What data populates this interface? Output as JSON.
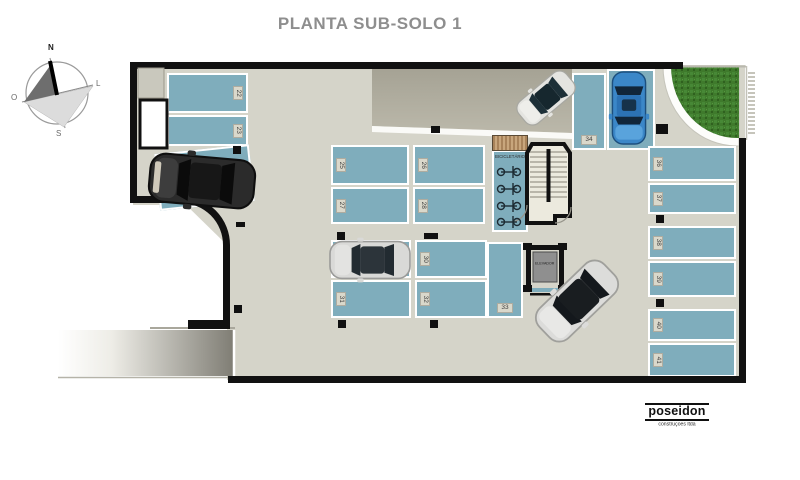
{
  "title": "PLANTA SUB-SOLO 1",
  "compass": {
    "north": "N",
    "south": "S",
    "east": "L",
    "west": "O"
  },
  "plan": {
    "spots": {
      "s22": "22",
      "s23": "23",
      "s25": "25",
      "s26": "26",
      "s27": "27",
      "s28": "28",
      "s30": "30",
      "s31": "31",
      "s32": "32",
      "s33": "33",
      "s34": "34",
      "s36": "36",
      "s37": "37",
      "s38": "38",
      "s39": "39",
      "s40": "40",
      "s41": "41"
    },
    "rooms": {
      "bike_storage": "BICICLETÁRIO",
      "elevator": "ELEVADOR"
    }
  },
  "logo": {
    "name": "poseidon",
    "subtitle": "construções ltda"
  },
  "colors": {
    "parking_spot": "#7fadbc",
    "floor": "#d5d4c9",
    "wall": "#111111",
    "grass": "#3f7a2c",
    "title_text": "#8e8e8e"
  }
}
